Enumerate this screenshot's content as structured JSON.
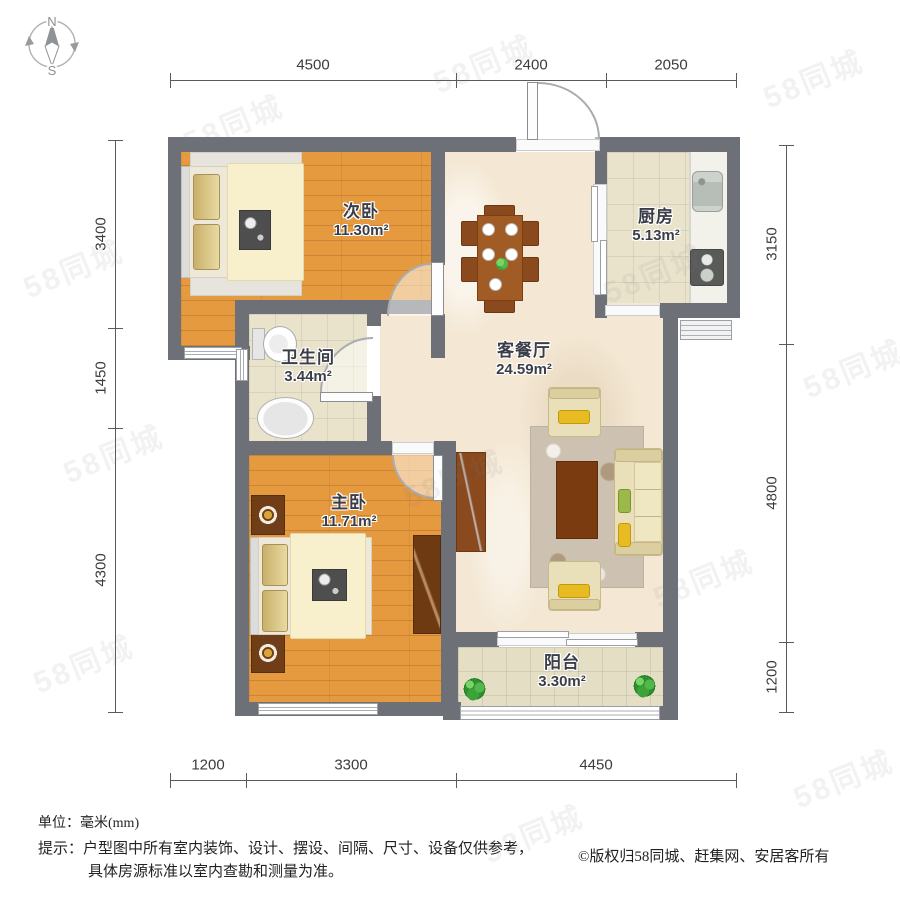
{
  "compass": {
    "north": "N",
    "south": "S"
  },
  "dimensions": {
    "top": [
      "4500",
      "2400",
      "2050"
    ],
    "bottom": [
      "1200",
      "3300",
      "4450"
    ],
    "left": [
      "3400",
      "1450",
      "4300"
    ],
    "right": [
      "3150",
      "4800",
      "1200"
    ]
  },
  "rooms": [
    {
      "id": "secondary-bedroom",
      "name": "次卧",
      "area": "11.30m²"
    },
    {
      "id": "kitchen",
      "name": "厨房",
      "area": "5.13m²"
    },
    {
      "id": "living-dining",
      "name": "客餐厅",
      "area": "24.59m²"
    },
    {
      "id": "bathroom",
      "name": "卫生间",
      "area": "3.44m²"
    },
    {
      "id": "master-bedroom",
      "name": "主卧",
      "area": "11.71m²"
    },
    {
      "id": "balcony",
      "name": "阳台",
      "area": "3.30m²"
    }
  ],
  "footer": {
    "unit_label": "单位：毫米(mm)",
    "tip_line1": "提示：户型图中所有室内装饰、设计、摆设、间隔、尺寸、设备仅供参考，",
    "tip_line2": "具体房源标准以室内查勘和测量为准。",
    "copyright": "©版权归58同城、赶集网、安居客所有"
  },
  "watermark": {
    "text": "58同城"
  }
}
